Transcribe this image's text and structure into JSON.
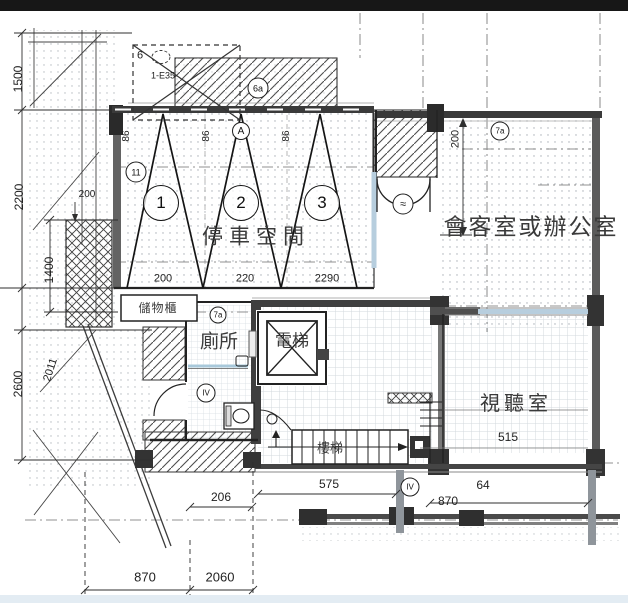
{
  "drawing": {
    "rooms": {
      "parking": "停車空間",
      "meeting": "會客室或辦公室",
      "av_room": "視聽室",
      "toilet": "廁所",
      "elevator": "電梯",
      "stairs": "樓梯",
      "storage": "儲物櫃"
    },
    "stalls": [
      "1",
      "2",
      "3"
    ],
    "window_tags": [
      "86",
      "86",
      "86"
    ],
    "tags": {
      "grid_11": "11",
      "apex_a": "A",
      "beam_6a": "6a",
      "room_7a": "7a",
      "toilet_7a": "7a",
      "toilet_iv": "IV",
      "bottom_iv": "IV",
      "door_tag": "≈"
    },
    "notes": {
      "number": "6",
      "code": "1-E35"
    },
    "dimensions": {
      "left_top": "1500",
      "left_upper": "2200",
      "left_block": "1400",
      "left_lower": "2600",
      "left_diag": "2011",
      "left_small": "200",
      "stall_1": "200",
      "stall_2": "220",
      "stall_3": "2290",
      "door_depth": "200",
      "bottom_206": "206",
      "stair_width": "575",
      "mid_bottom": "870",
      "right_64": "64",
      "av_515": "515",
      "far_left": "870",
      "far_right": "2060"
    },
    "colors": {
      "wall_dark": "#3a3a3a",
      "wall_gray": "#8f959b",
      "window_blue": "#b7cede",
      "top_bar": "#171717",
      "bottom_strip": "#e3ecf3",
      "line": "#222222"
    }
  }
}
